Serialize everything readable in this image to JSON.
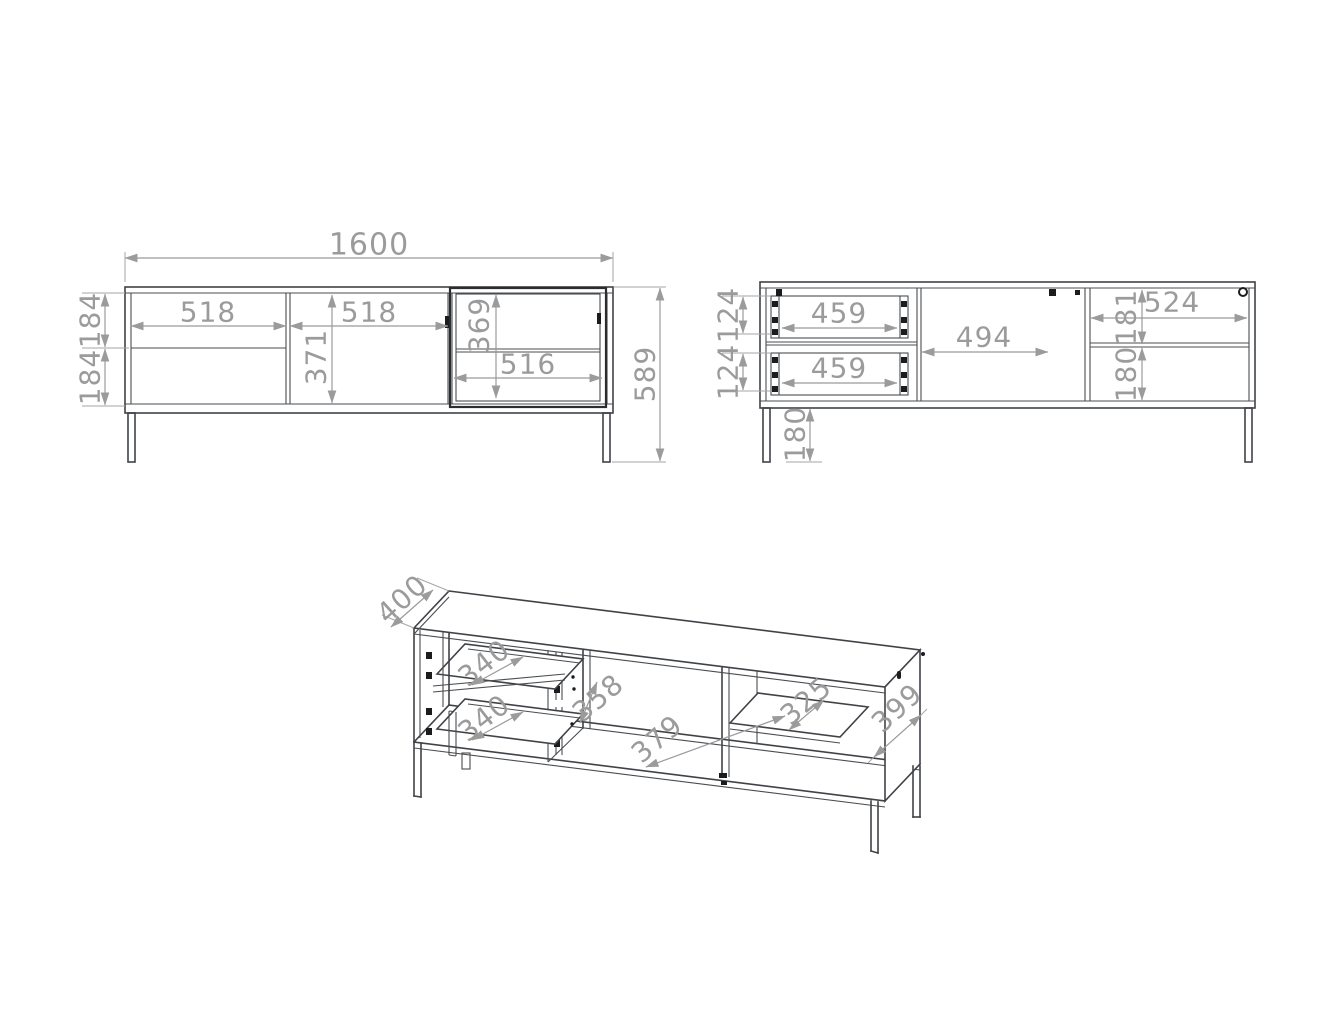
{
  "views": {
    "front": {
      "labels": {
        "overall_width": "1600",
        "overall_height": "589",
        "drawer_section_width": "518",
        "door_width": "518",
        "door_height": "371",
        "glass_door_height": "369",
        "glass_shelf_width": "516",
        "top_drawer_front_height": "184",
        "bottom_drawer_front_height": "184"
      }
    },
    "back": {
      "labels": {
        "top_drawer_width": "459",
        "bottom_drawer_width": "459",
        "top_drawer_back_height": "124",
        "bottom_drawer_back_height": "124",
        "middle_opening_width": "494",
        "right_section_width": "524",
        "above_shelf_height": "181",
        "below_shelf_height": "180",
        "leg_height": "180"
      }
    },
    "iso": {
      "labels": {
        "depth": "400",
        "top_drawer_depth": "340",
        "bottom_drawer_depth": "340",
        "middle_inner_height": "358",
        "middle_floor_width": "379",
        "shelf_depth": "325",
        "side_panel_depth": "399"
      }
    }
  },
  "colors": {
    "line": "#3f4247",
    "dimension": "#9b9b9b",
    "background": "#ffffff"
  }
}
